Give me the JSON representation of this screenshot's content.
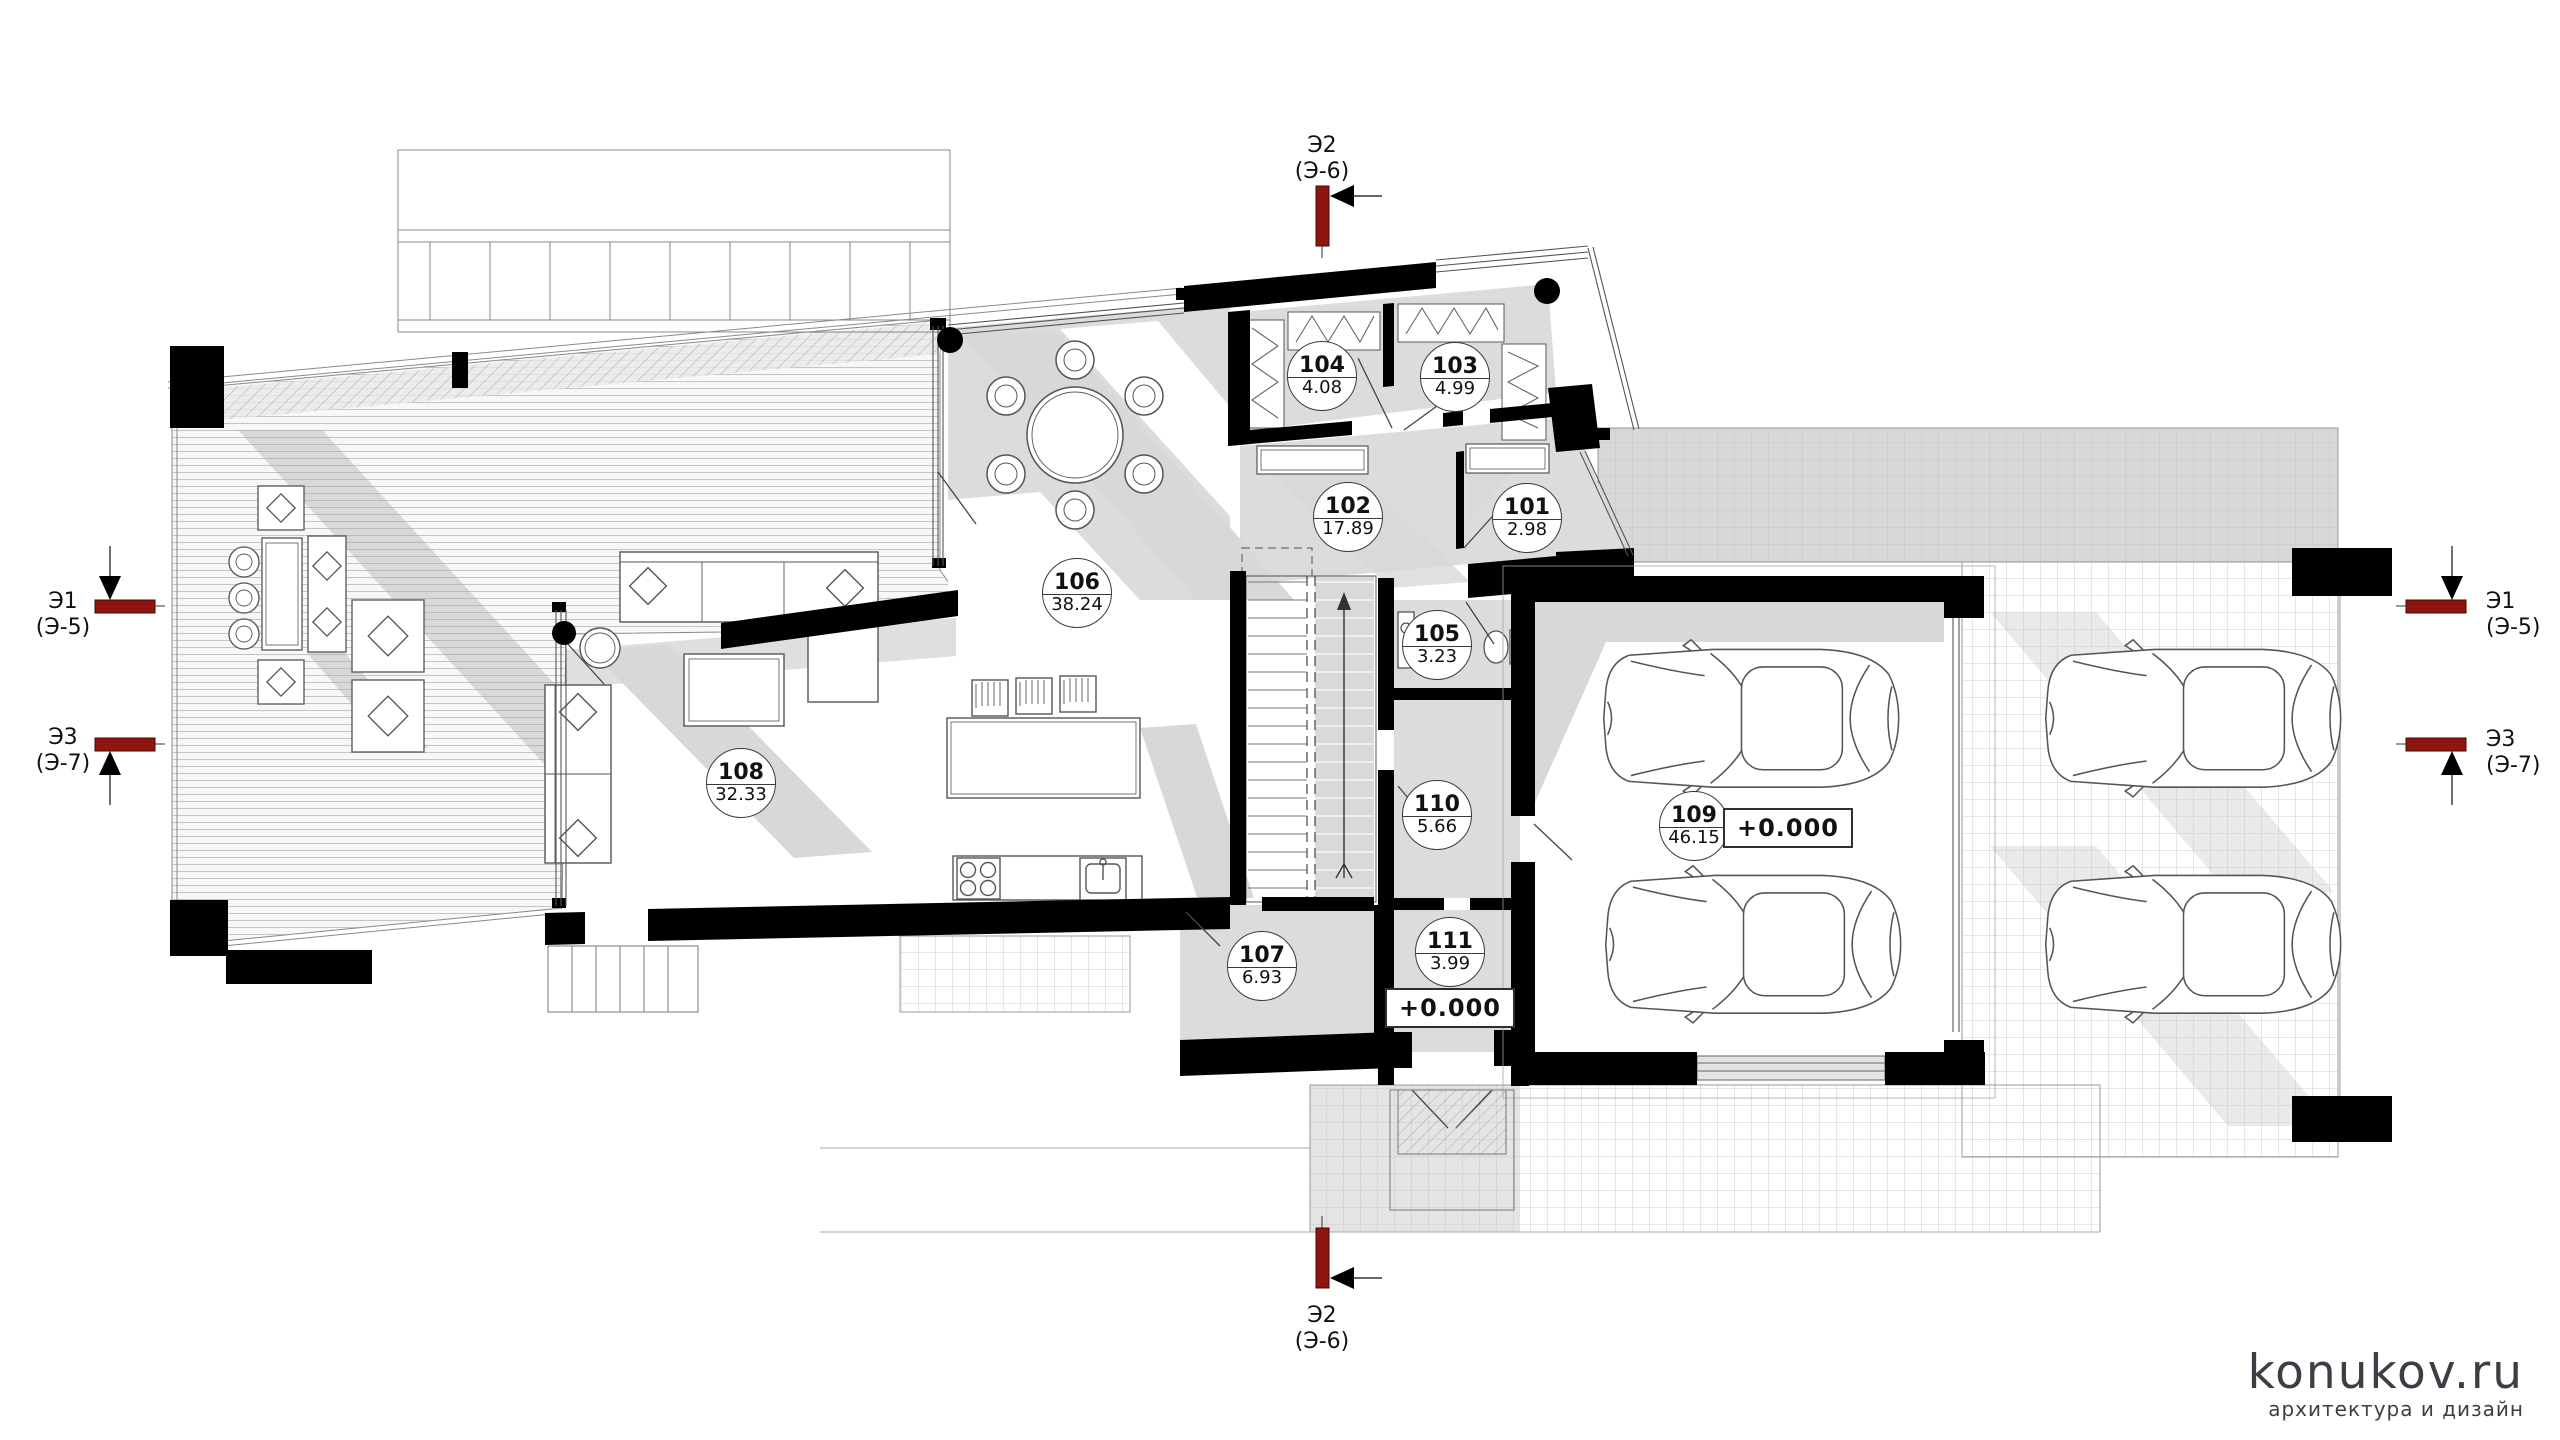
{
  "drawing": {
    "type": "architectural-floor-plan",
    "floor": "first floor"
  },
  "rooms": [
    {
      "number": "101",
      "area": "2.98",
      "x": 1527,
      "y": 518
    },
    {
      "number": "102",
      "area": "17.89",
      "x": 1348,
      "y": 517
    },
    {
      "number": "103",
      "area": "4.99",
      "x": 1455,
      "y": 377
    },
    {
      "number": "104",
      "area": "4.08",
      "x": 1322,
      "y": 376
    },
    {
      "number": "105",
      "area": "3.23",
      "x": 1437,
      "y": 645
    },
    {
      "number": "106",
      "area": "38.24",
      "x": 1077,
      "y": 593
    },
    {
      "number": "107",
      "area": "6.93",
      "x": 1262,
      "y": 966
    },
    {
      "number": "108",
      "area": "32.33",
      "x": 741,
      "y": 783
    },
    {
      "number": "109",
      "area": "46.15",
      "x": 1694,
      "y": 826
    },
    {
      "number": "110",
      "area": "5.66",
      "x": 1437,
      "y": 815
    },
    {
      "number": "111",
      "area": "3.99",
      "x": 1450,
      "y": 952
    }
  ],
  "levels": [
    {
      "label": "+0.000",
      "x": 1788,
      "y": 828
    },
    {
      "label": "+0.000",
      "x": 1450,
      "y": 1008
    }
  ],
  "sections": [
    {
      "id": "top",
      "label": "Э2",
      "ref": "(Э-6)"
    },
    {
      "id": "bottom",
      "label": "Э2",
      "ref": "(Э-6)"
    },
    {
      "id": "left-upper",
      "label": "Э1",
      "ref": "(Э-5)"
    },
    {
      "id": "left-lower",
      "label": "Э3",
      "ref": "(Э-7)"
    },
    {
      "id": "right-upper",
      "label": "Э1",
      "ref": "(Э-5)"
    },
    {
      "id": "right-lower",
      "label": "Э3",
      "ref": "(Э-7)"
    }
  ],
  "watermark": {
    "brand": "konukov.ru",
    "tagline": "архитектура и дизайн"
  },
  "colors": {
    "wall": "#000000",
    "section_marker": "#8e1510",
    "floor_shade": "#dcdcdc",
    "shadow": "#d8d8d8",
    "line": "#555555",
    "watermark": "#3d3d45"
  }
}
